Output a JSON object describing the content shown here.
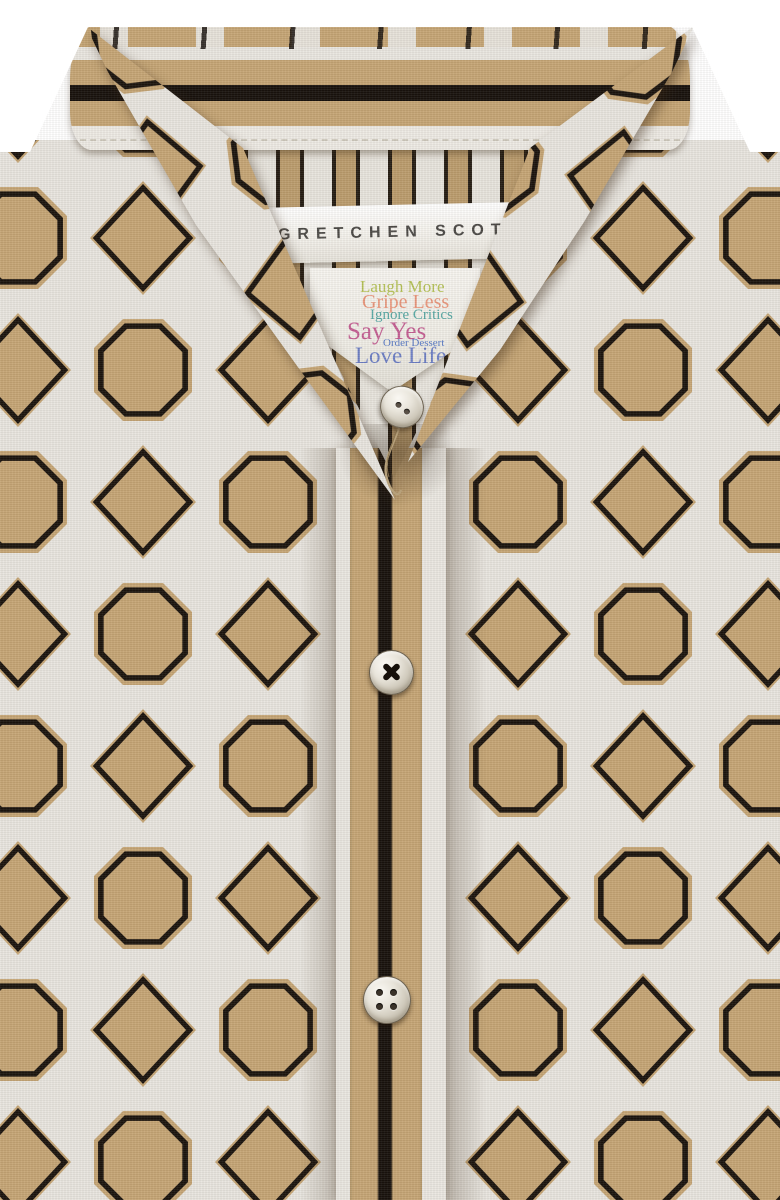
{
  "image": {
    "type": "product-photo",
    "subject": "button-front shirt collar and placket detail",
    "width_px": 780,
    "height_px": 1200
  },
  "brand_label": {
    "text": "GRETCHEN SCOTT",
    "text_color": "#4b4946",
    "background": "#f6f4ef"
  },
  "care_label": {
    "background": "#f3f1ea",
    "lines": [
      {
        "text": "Laugh More",
        "color": "#b4c155"
      },
      {
        "text": "Gripe Less",
        "color": "#e9957a"
      },
      {
        "text": "Ignore Critics",
        "color": "#55a7a3"
      },
      {
        "text": "Say Yes",
        "color": "#c45f93"
      },
      {
        "text": "Order Dessert",
        "color": "#5577c4"
      },
      {
        "text": "Love Life",
        "color": "#6c7ec5"
      }
    ]
  },
  "fabric": {
    "pattern": "octagon-and-diamond trellis print",
    "ground_color": "#c5a575",
    "lattice_color": "#e8e5df",
    "outline_color": "#1a130d"
  },
  "collar_band": {
    "stripes": [
      "tan",
      "white",
      "tan",
      "black",
      "tan",
      "white binding"
    ],
    "stripe_colors": [
      "#c5a575",
      "#e9e6e0",
      "#17110c",
      "#edeae4"
    ]
  },
  "placket": {
    "stripes": [
      "white",
      "tan",
      "black",
      "tan",
      "white"
    ],
    "center_stripe_color": "#17110c"
  },
  "buttons": [
    {
      "name": "top-button",
      "style": "pearl, 2-hole"
    },
    {
      "name": "middle-button",
      "style": "pearl, black X cross-stitch"
    },
    {
      "name": "bottom-button",
      "style": "pearl, 4-hole"
    }
  ]
}
